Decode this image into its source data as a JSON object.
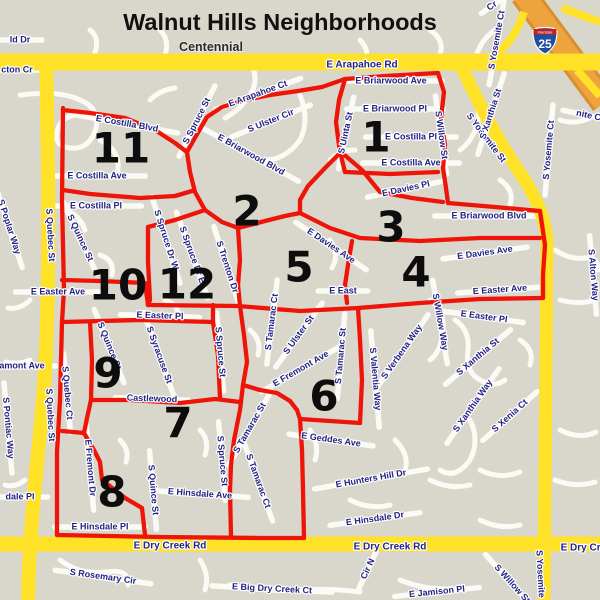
{
  "title": "Walnut Hills Neighborhoods",
  "area_label": "Centennial",
  "interstate_shield": {
    "banner": "Interstate",
    "number": "25"
  },
  "colors": {
    "background": "#d9d7cc",
    "street": "#fbfaf5",
    "yellow_road": "#ffe128",
    "orange_highway": "#eda43f",
    "orange_highway_edge": "#d98f2b",
    "red_boundary": "#ee1408",
    "label_blue": "#232384",
    "number_black": "#0d0d0d"
  },
  "region_numbers": [
    {
      "n": "1",
      "x": 376,
      "y": 137
    },
    {
      "n": "2",
      "x": 247,
      "y": 211
    },
    {
      "n": "3",
      "x": 391,
      "y": 227
    },
    {
      "n": "4",
      "x": 416,
      "y": 272
    },
    {
      "n": "5",
      "x": 299,
      "y": 267
    },
    {
      "n": "6",
      "x": 324,
      "y": 396
    },
    {
      "n": "7",
      "x": 178,
      "y": 423
    },
    {
      "n": "8",
      "x": 112,
      "y": 492
    },
    {
      "n": "9",
      "x": 108,
      "y": 373
    },
    {
      "n": "10",
      "x": 118,
      "y": 285
    },
    {
      "n": "11",
      "x": 121,
      "y": 148
    },
    {
      "n": "12",
      "x": 187,
      "y": 284
    }
  ],
  "street_labels": [
    {
      "t": "E Arapahoe Rd",
      "x": 362,
      "y": 65,
      "r": 0,
      "road": true,
      "s": 10
    },
    {
      "t": "E Arapahoe Ct",
      "x": 258,
      "y": 94,
      "r": -20
    },
    {
      "t": "S Spruce St",
      "x": 197,
      "y": 121,
      "r": -63
    },
    {
      "t": "S Ulster Cir",
      "x": 271,
      "y": 121,
      "r": -22
    },
    {
      "t": "E Briarwood Ave",
      "x": 391,
      "y": 81,
      "r": 0
    },
    {
      "t": "E Briarwood Pl",
      "x": 395,
      "y": 109,
      "r": 0
    },
    {
      "t": "S Uinta St",
      "x": 346,
      "y": 133,
      "r": -78
    },
    {
      "t": "E Costilla Pl",
      "x": 411,
      "y": 137,
      "r": 0
    },
    {
      "t": "E Costilla Ave",
      "x": 411,
      "y": 163,
      "r": 0
    },
    {
      "t": "S Willow St",
      "x": 441,
      "y": 135,
      "r": 82
    },
    {
      "t": "S Yosemite St",
      "x": 486,
      "y": 138,
      "r": 53,
      "road": true
    },
    {
      "t": "S Xanthia St",
      "x": 491,
      "y": 114,
      "r": -72
    },
    {
      "t": "S Yosemite Ct",
      "x": 497,
      "y": 40,
      "r": -80
    },
    {
      "t": "S Yosemite Ct",
      "x": 549,
      "y": 150,
      "r": -85
    },
    {
      "t": "nite Ct",
      "x": 590,
      "y": 116,
      "r": 12
    },
    {
      "t": "Cr",
      "x": 492,
      "y": 6,
      "r": -35
    },
    {
      "t": "E Costilla Blvd",
      "x": 127,
      "y": 124,
      "r": 10
    },
    {
      "t": "E Costilla Ave",
      "x": 97,
      "y": 176,
      "r": 0
    },
    {
      "t": "E Costilla Pl",
      "x": 96,
      "y": 206,
      "r": 0
    },
    {
      "t": "S Quince St",
      "x": 80,
      "y": 238,
      "r": 65
    },
    {
      "t": "S Quebec St",
      "x": 50,
      "y": 235,
      "r": 87,
      "road": true
    },
    {
      "t": "S Quebec St",
      "x": 50,
      "y": 415,
      "r": 87,
      "road": true
    },
    {
      "t": "S Poplar Way",
      "x": 9,
      "y": 227,
      "r": 72
    },
    {
      "t": "amont Ave",
      "x": 22,
      "y": 366,
      "r": 0
    },
    {
      "t": "S Pontiac Way",
      "x": 8,
      "y": 428,
      "r": 85
    },
    {
      "t": "ld Dr",
      "x": 20,
      "y": 40,
      "r": 0
    },
    {
      "t": "cton Cr",
      "x": 17,
      "y": 70,
      "r": 0
    },
    {
      "t": "dale Pl",
      "x": 20,
      "y": 497,
      "r": 0
    },
    {
      "t": "S Spruce Dr W",
      "x": 166,
      "y": 240,
      "r": 72
    },
    {
      "t": "S Spruce Dr E",
      "x": 192,
      "y": 255,
      "r": 70
    },
    {
      "t": "S Trenton Dr",
      "x": 227,
      "y": 267,
      "r": 72
    },
    {
      "t": "E Briarwood Blvd",
      "x": 251,
      "y": 155,
      "r": 29
    },
    {
      "t": "E Briarwood Blvd",
      "x": 489,
      "y": 216,
      "r": 0
    },
    {
      "t": "E Davies Pl",
      "x": 406,
      "y": 189,
      "r": -12
    },
    {
      "t": "E Davies Ave",
      "x": 331,
      "y": 246,
      "r": 34
    },
    {
      "t": "E Davies Ave",
      "x": 485,
      "y": 253,
      "r": -8
    },
    {
      "t": "E Easter Ave",
      "x": 500,
      "y": 290,
      "r": -4
    },
    {
      "t": "E East",
      "x": 343,
      "y": 291,
      "r": 0
    },
    {
      "t": "E Easter Ave",
      "x": 58,
      "y": 292,
      "r": 0
    },
    {
      "t": "E Easter Pl",
      "x": 160,
      "y": 316,
      "r": 2
    },
    {
      "t": "E Easter Pl",
      "x": 484,
      "y": 317,
      "r": 8
    },
    {
      "t": "S Ulster St",
      "x": 299,
      "y": 335,
      "r": -54
    },
    {
      "t": "S Tamarac Ct",
      "x": 272,
      "y": 322,
      "r": -83
    },
    {
      "t": "S Tamarac St",
      "x": 341,
      "y": 356,
      "r": -85
    },
    {
      "t": "S Tamarac St",
      "x": 250,
      "y": 428,
      "r": -60
    },
    {
      "t": "S Tamarac Ct",
      "x": 258,
      "y": 481,
      "r": 70
    },
    {
      "t": "E Fremont Ave",
      "x": 301,
      "y": 369,
      "r": -30
    },
    {
      "t": "Castlewood",
      "x": 152,
      "y": 399,
      "r": 2
    },
    {
      "t": "S Quebec Ct",
      "x": 67,
      "y": 393,
      "r": 85
    },
    {
      "t": "S Quince St",
      "x": 109,
      "y": 346,
      "r": 68
    },
    {
      "t": "S Syracuse St",
      "x": 159,
      "y": 355,
      "r": 70
    },
    {
      "t": "S Spruce St",
      "x": 220,
      "y": 352,
      "r": 85
    },
    {
      "t": "S Spruce St",
      "x": 222,
      "y": 461,
      "r": 85
    },
    {
      "t": "S Quince St",
      "x": 153,
      "y": 490,
      "r": 85
    },
    {
      "t": "E Hinsdale Ave",
      "x": 200,
      "y": 494,
      "r": 4
    },
    {
      "t": "E Hinsdale Pl",
      "x": 100,
      "y": 527,
      "r": 0
    },
    {
      "t": "E Fremont Dr",
      "x": 90,
      "y": 468,
      "r": 85
    },
    {
      "t": "E Geddes Ave",
      "x": 331,
      "y": 440,
      "r": 8
    },
    {
      "t": "E Hunters Hill Dr",
      "x": 371,
      "y": 479,
      "r": -10
    },
    {
      "t": "E Hinsdale Dr",
      "x": 375,
      "y": 519,
      "r": -8
    },
    {
      "t": "S Valentia Way",
      "x": 375,
      "y": 379,
      "r": 85
    },
    {
      "t": "S Verbena Way",
      "x": 402,
      "y": 352,
      "r": -55
    },
    {
      "t": "S Willow Way",
      "x": 440,
      "y": 322,
      "r": 80
    },
    {
      "t": "S Xanthia St",
      "x": 478,
      "y": 357,
      "r": -40
    },
    {
      "t": "S Xanthia Way",
      "x": 473,
      "y": 406,
      "r": -55
    },
    {
      "t": "S Xenia Ct",
      "x": 510,
      "y": 416,
      "r": -42
    },
    {
      "t": "S Alton Way",
      "x": 593,
      "y": 275,
      "r": 85
    },
    {
      "t": "E Dry Creek Rd",
      "x": 170,
      "y": 546,
      "r": 0,
      "road": true,
      "s": 10
    },
    {
      "t": "E Dry Creek Rd",
      "x": 390,
      "y": 547,
      "r": 0,
      "road": true,
      "s": 10
    },
    {
      "t": "E Dry Creek Rd",
      "x": 597,
      "y": 548,
      "r": 0,
      "road": true,
      "s": 10
    },
    {
      "t": "S Yosemite",
      "x": 540,
      "y": 574,
      "r": 87,
      "road": true
    },
    {
      "t": "S Rosemary Cir",
      "x": 103,
      "y": 577,
      "r": 8
    },
    {
      "t": "E Big Dry Creek Ct",
      "x": 272,
      "y": 589,
      "r": 3
    },
    {
      "t": "E Jamison Pl",
      "x": 437,
      "y": 592,
      "r": -6
    },
    {
      "t": "Cir N",
      "x": 368,
      "y": 569,
      "r": -65
    },
    {
      "t": "S Willow St",
      "x": 512,
      "y": 584,
      "r": 48
    }
  ]
}
